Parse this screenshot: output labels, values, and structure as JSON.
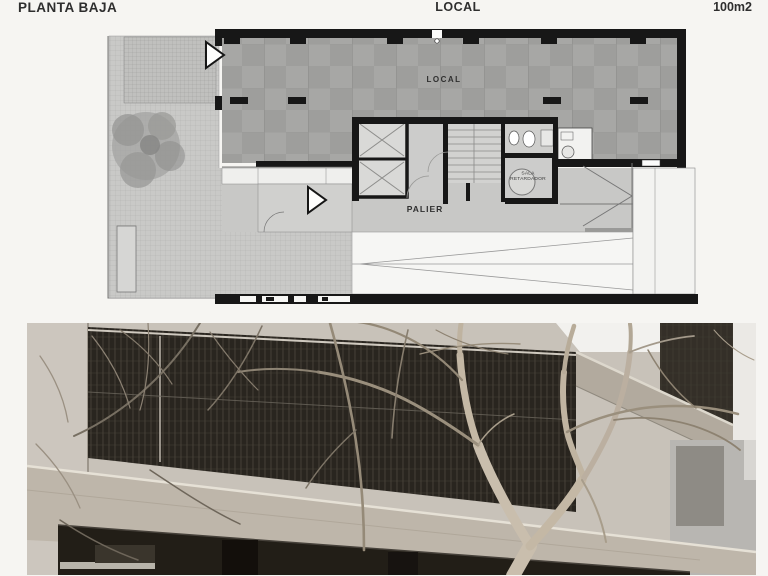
{
  "header": {
    "left": "PLANTA BAJA",
    "center": "LOCAL",
    "right": "100m2"
  },
  "plan": {
    "labels": {
      "local": "LOCAL",
      "palier": "PALIER",
      "sala_line1": "SALA",
      "sala_line2": "RETARDADOR"
    }
  },
  "colors": {
    "page_bg": "#f6f5f2",
    "wall_black": "#171717",
    "tile_gray": "#9e9e9c",
    "terrace_gray": "#c9c9c7",
    "palier_gray": "#c8c8c6",
    "photo_concrete": "#c8c2b9",
    "photo_mesh_dark": "#29251f",
    "photo_glass_dark": "#221e17",
    "photo_slab": "#b2aa9e",
    "tree_trunk": "#c9bead"
  }
}
